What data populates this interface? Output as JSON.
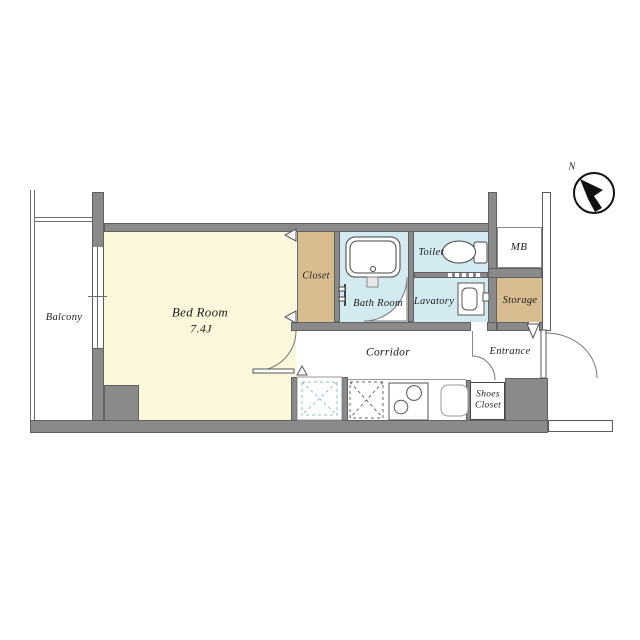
{
  "labels": {
    "balcony": "Balcony",
    "bedroom": "Bed Room",
    "bedroom_size": "7.4J",
    "closet": "Closet",
    "bathroom": "Bath Room",
    "toilet": "Toilet",
    "lavatory": "Lavatory",
    "storage": "Storage",
    "meter_box": "MB",
    "corridor": "Corridor",
    "entrance": "Entrance",
    "shoes_closet_line1": "Shoes",
    "shoes_closet_line2": "Closet",
    "compass_north": "N"
  },
  "colors": {
    "wall": "#8a8a8a",
    "room_cream": "#faf7db",
    "closet_tan": "#d8bd90",
    "wet_area_blue": "#d3eaf1",
    "outline": "#555555",
    "text": "#1c1c1c",
    "washer_dash_blue": "#8fc0cd"
  }
}
